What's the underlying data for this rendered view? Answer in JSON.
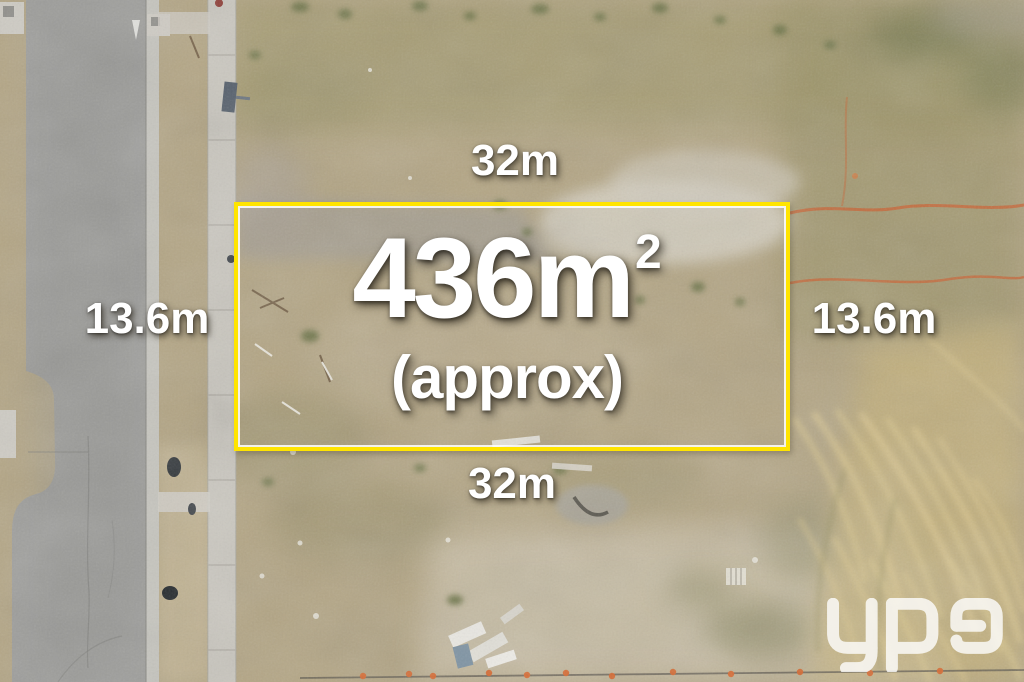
{
  "scene": {
    "type": "aerial drone photograph",
    "subject": "vacant residential land lot outlined for sale, bordered by a road and concrete footpath",
    "boundary_color": "#FFE400",
    "label_color": "#FFFFFF",
    "barrier_color": "#C76434"
  },
  "labels": {
    "top_width": "32m",
    "bottom_width": "32m",
    "left_depth": "13.6m",
    "right_depth": "13.6m",
    "area_value": "436m",
    "area_exponent": "2",
    "area_qualifier": "(approx)"
  },
  "watermark": {
    "logo_text": "ypa"
  }
}
